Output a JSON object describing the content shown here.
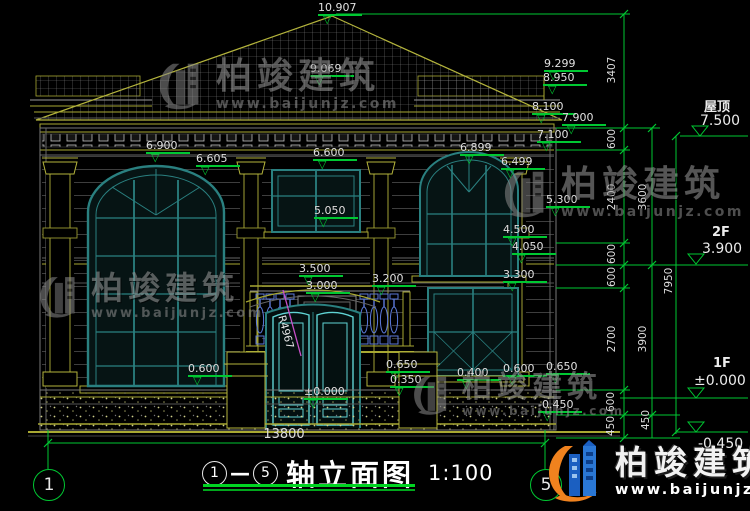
{
  "colors": {
    "background": "#000000",
    "dim_green": "#00c832",
    "olive": "#b4b43c",
    "gray_line": "#4a4a4a",
    "window_teal": "#2a8080",
    "door_cyan": "#5fd3d3",
    "baluster_blue": "#5b79d9",
    "magenta": "#c94fc9",
    "text": "#e8e8e8",
    "logo_blue": "#1b5fc1",
    "logo_orange": "#f0821e"
  },
  "icons": {
    "level_triangle": "▽"
  },
  "watermark": {
    "brand": "柏竣建筑",
    "url": "www.baijunjz.com"
  },
  "watermarks": [
    {
      "x": 155,
      "y": 58,
      "f": 36
    },
    {
      "x": 500,
      "y": 166,
      "f": 36
    },
    {
      "x": 36,
      "y": 272,
      "f": 32
    },
    {
      "x": 410,
      "y": 372,
      "f": 30
    }
  ],
  "elevation_markers": [
    {
      "value": "10.907",
      "x": 318,
      "y": 2
    },
    {
      "value": "9.069",
      "x": 310,
      "y": 63
    },
    {
      "value": "9.299",
      "x": 544,
      "y": 58
    },
    {
      "value": "8.950",
      "x": 543,
      "y": 72
    },
    {
      "value": "8.100",
      "x": 532,
      "y": 101
    },
    {
      "value": "7.900",
      "x": 562,
      "y": 112
    },
    {
      "value": "7.100",
      "x": 537,
      "y": 129
    },
    {
      "value": "6.900",
      "x": 146,
      "y": 140
    },
    {
      "value": "6.605",
      "x": 196,
      "y": 153
    },
    {
      "value": "6.600",
      "x": 313,
      "y": 147
    },
    {
      "value": "6.899",
      "x": 460,
      "y": 142
    },
    {
      "value": "6.499",
      "x": 501,
      "y": 156
    },
    {
      "value": "5.300",
      "x": 546,
      "y": 194
    },
    {
      "value": "5.050",
      "x": 314,
      "y": 205
    },
    {
      "value": "4.500",
      "x": 503,
      "y": 224
    },
    {
      "value": "4.050",
      "x": 512,
      "y": 241
    },
    {
      "value": "3.500",
      "x": 299,
      "y": 263
    },
    {
      "value": "3.300",
      "x": 503,
      "y": 269
    },
    {
      "value": "3.000",
      "x": 306,
      "y": 280
    },
    {
      "value": "3.200",
      "x": 372,
      "y": 273
    },
    {
      "value": "0.600",
      "x": 188,
      "y": 363
    },
    {
      "value": "0.650",
      "x": 386,
      "y": 359
    },
    {
      "value": "0.350",
      "x": 390,
      "y": 374
    },
    {
      "value": "0.400",
      "x": 457,
      "y": 367
    },
    {
      "value": "0.600",
      "x": 503,
      "y": 363
    },
    {
      "value": "0.650",
      "x": 546,
      "y": 361
    },
    {
      "value": "±0.000",
      "x": 304,
      "y": 386
    },
    {
      "value": "-0.450",
      "x": 538,
      "y": 399
    }
  ],
  "level_markers": [
    {
      "label": "屋顶",
      "value": "7.500",
      "lx": 704,
      "ly": 96,
      "vx": 700,
      "vy": 113
    },
    {
      "label": "2F",
      "value": "3.900",
      "lx": 712,
      "ly": 225,
      "vx": 702,
      "vy": 241
    },
    {
      "label": "1F",
      "value": "±0.000",
      "lx": 713,
      "ly": 356,
      "vx": 694,
      "vy": 373
    },
    {
      "label": "",
      "value": "-0.450",
      "lx": 0,
      "ly": 0,
      "vx": 698,
      "vy": 436
    }
  ],
  "dim_chain_texts": [
    {
      "v": "3407",
      "x": 612,
      "y": 70
    },
    {
      "v": "600",
      "x": 612,
      "y": 139
    },
    {
      "v": "2400",
      "x": 612,
      "y": 197
    },
    {
      "v": "600",
      "x": 612,
      "y": 254
    },
    {
      "v": "600",
      "x": 612,
      "y": 277
    },
    {
      "v": "2700",
      "x": 612,
      "y": 339
    },
    {
      "v": "600",
      "x": 611,
      "y": 402
    },
    {
      "v": "450",
      "x": 611,
      "y": 426
    },
    {
      "v": "3600",
      "x": 643,
      "y": 197
    },
    {
      "v": "3900",
      "x": 643,
      "y": 339
    },
    {
      "v": "450",
      "x": 646,
      "y": 420
    },
    {
      "v": "7950",
      "x": 669,
      "y": 281
    }
  ],
  "width_dim": {
    "value": "13800"
  },
  "radius_label": "R4967",
  "title_block": {
    "axis_start": "1",
    "axis_end": "5",
    "dash": "—",
    "name": "轴立面图",
    "scale": "1:100"
  },
  "axis_bubbles": [
    {
      "n": "1",
      "x": 48,
      "y": 484
    },
    {
      "n": "5",
      "x": 545,
      "y": 484
    }
  ],
  "corner_logo": {
    "brand": "柏竣建筑",
    "url": "www.baijunjz.com"
  }
}
